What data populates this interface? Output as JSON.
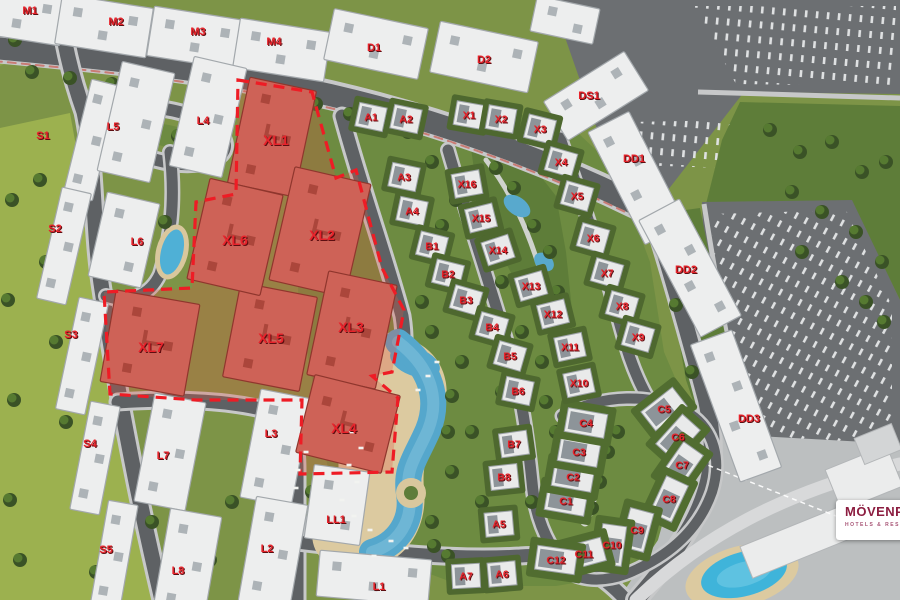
{
  "scene": {
    "width": 900,
    "height": 600,
    "kind": "residential-masterplan-aerial-view"
  },
  "brand": {
    "name": "MÖVENPICK",
    "tagline": "HOTELS & RESORTS",
    "name_color": "#8c1d40",
    "tagline_color": "#a85576"
  },
  "palette": {
    "label_red": "#e8232b",
    "label_shadow": "#5d0e11",
    "block_fill": "#edeeee",
    "block_stroke": "#a3a8ac",
    "block_roof": "#adb3b7",
    "highlight_fill": "#ce6257",
    "highlight_stroke": "#8f362d",
    "highlight_roof": "#ab463b",
    "boundary_red": "#ee1c25",
    "villa_fill": "#e9eaea",
    "villa_stroke": "#9aa0a4",
    "villa_roof": "#8d9499",
    "yard_green": "#4e682f",
    "yard_green_c": "#516d30"
  },
  "highlighted_blocks": [
    {
      "id": "XL1",
      "label": "XL1",
      "x": 272,
      "y": 137,
      "w": 68,
      "h": 108,
      "rot": 12,
      "lx": 276,
      "ly": 140
    },
    {
      "id": "XL2",
      "label": "XL2",
      "x": 320,
      "y": 232,
      "w": 78,
      "h": 116,
      "rot": 13,
      "lx": 322,
      "ly": 235
    },
    {
      "id": "XL3",
      "label": "XL3",
      "x": 352,
      "y": 330,
      "w": 70,
      "h": 106,
      "rot": 12,
      "lx": 351,
      "ly": 327
    },
    {
      "id": "XL4",
      "label": "XL4",
      "x": 348,
      "y": 424,
      "w": 88,
      "h": 80,
      "rot": 14,
      "lx": 344,
      "ly": 428
    },
    {
      "id": "XL5",
      "label": "XL5",
      "x": 270,
      "y": 337,
      "w": 78,
      "h": 96,
      "rot": 11,
      "lx": 271,
      "ly": 338
    },
    {
      "id": "XL6",
      "label": "XL6",
      "x": 235,
      "y": 237,
      "w": 75,
      "h": 103,
      "rot": 13,
      "lx": 235,
      "ly": 240
    },
    {
      "id": "XL7",
      "label": "XL7",
      "x": 150,
      "y": 343,
      "w": 85,
      "h": 93,
      "rot": 10,
      "lx": 151,
      "ly": 347
    }
  ],
  "apartment_blocks": [
    {
      "id": "M1",
      "label": "M1",
      "x": 18,
      "y": 14,
      "w": 92,
      "h": 50,
      "rot": 9,
      "lx": 30,
      "ly": 10
    },
    {
      "id": "M2",
      "label": "M2",
      "x": 104,
      "y": 26,
      "w": 92,
      "h": 50,
      "rot": 9,
      "lx": 116,
      "ly": 21
    },
    {
      "id": "M3",
      "label": "M3",
      "x": 196,
      "y": 38,
      "w": 92,
      "h": 50,
      "rot": 9,
      "lx": 198,
      "ly": 31
    },
    {
      "id": "M4",
      "label": "M4",
      "x": 282,
      "y": 50,
      "w": 92,
      "h": 50,
      "rot": 9,
      "lx": 274,
      "ly": 41
    },
    {
      "id": "D1",
      "label": "D1",
      "x": 376,
      "y": 44,
      "w": 96,
      "h": 52,
      "rot": 12,
      "lx": 374,
      "ly": 47
    },
    {
      "id": "D2",
      "label": "D2",
      "x": 484,
      "y": 57,
      "w": 100,
      "h": 52,
      "rot": 12,
      "lx": 484,
      "ly": 59
    },
    {
      "id": "D3",
      "label": "",
      "x": 565,
      "y": 20,
      "w": 64,
      "h": 36,
      "rot": 12,
      "lx": 0,
      "ly": 0
    },
    {
      "id": "DS1",
      "label": "DS1",
      "x": 596,
      "y": 96,
      "w": 95,
      "h": 46,
      "rot": -32,
      "lx": 589,
      "ly": 95
    },
    {
      "id": "DD1",
      "label": "DD1",
      "x": 637,
      "y": 178,
      "w": 46,
      "h": 126,
      "rot": -27,
      "lx": 634,
      "ly": 158
    },
    {
      "id": "DD2",
      "label": "DD2",
      "x": 690,
      "y": 268,
      "w": 46,
      "h": 132,
      "rot": -28,
      "lx": 686,
      "ly": 269
    },
    {
      "id": "DD3",
      "label": "DD3",
      "x": 736,
      "y": 406,
      "w": 44,
      "h": 146,
      "rot": -20,
      "lx": 749,
      "ly": 418
    },
    {
      "id": "S1",
      "label": "S1",
      "x": 92,
      "y": 140,
      "w": 30,
      "h": 118,
      "rot": 14,
      "lx": 43,
      "ly": 135
    },
    {
      "id": "S2",
      "label": "S2",
      "x": 64,
      "y": 246,
      "w": 30,
      "h": 114,
      "rot": 13,
      "lx": 55,
      "ly": 228
    },
    {
      "id": "S3",
      "label": "S3",
      "x": 82,
      "y": 356,
      "w": 30,
      "h": 114,
      "rot": 12,
      "lx": 71,
      "ly": 334
    },
    {
      "id": "S4",
      "label": "S4",
      "x": 95,
      "y": 458,
      "w": 30,
      "h": 110,
      "rot": 11,
      "lx": 90,
      "ly": 443
    },
    {
      "id": "S5",
      "label": "S5",
      "x": 114,
      "y": 556,
      "w": 30,
      "h": 108,
      "rot": 10,
      "lx": 106,
      "ly": 549
    },
    {
      "id": "L5",
      "label": "L5",
      "x": 136,
      "y": 122,
      "w": 54,
      "h": 112,
      "rot": 13,
      "lx": 113,
      "ly": 126
    },
    {
      "id": "L4",
      "label": "L4",
      "x": 208,
      "y": 117,
      "w": 54,
      "h": 112,
      "rot": 13,
      "lx": 203,
      "ly": 120
    },
    {
      "id": "L6",
      "label": "L6",
      "x": 124,
      "y": 240,
      "w": 54,
      "h": 86,
      "rot": 13,
      "lx": 137,
      "ly": 241
    },
    {
      "id": "L7",
      "label": "L7",
      "x": 170,
      "y": 452,
      "w": 52,
      "h": 110,
      "rot": 11,
      "lx": 163,
      "ly": 455
    },
    {
      "id": "L3",
      "label": "L3",
      "x": 276,
      "y": 448,
      "w": 52,
      "h": 110,
      "rot": 11,
      "lx": 271,
      "ly": 433
    },
    {
      "id": "L8",
      "label": "L8",
      "x": 187,
      "y": 565,
      "w": 52,
      "h": 106,
      "rot": 10,
      "lx": 178,
      "ly": 570
    },
    {
      "id": "L2",
      "label": "L2",
      "x": 273,
      "y": 553,
      "w": 52,
      "h": 106,
      "rot": 10,
      "lx": 267,
      "ly": 548
    },
    {
      "id": "L1",
      "label": "L1",
      "x": 374,
      "y": 578,
      "w": 112,
      "h": 46,
      "rot": 5,
      "lx": 379,
      "ly": 586
    },
    {
      "id": "LL1",
      "label": "LL1",
      "x": 337,
      "y": 505,
      "w": 56,
      "h": 74,
      "rot": 8,
      "lx": 336,
      "ly": 519
    }
  ],
  "villas": [
    {
      "id": "A1",
      "label": "A1",
      "x": 371,
      "y": 117,
      "rot": 12,
      "size": "std"
    },
    {
      "id": "A2",
      "label": "A2",
      "x": 406,
      "y": 119,
      "rot": 12,
      "size": "std"
    },
    {
      "id": "A3",
      "label": "A3",
      "x": 404,
      "y": 177,
      "rot": 12,
      "size": "std"
    },
    {
      "id": "A4",
      "label": "A4",
      "x": 412,
      "y": 211,
      "rot": 12,
      "size": "std"
    },
    {
      "id": "A5",
      "label": "A5",
      "x": 499,
      "y": 524,
      "rot": -5,
      "size": "std"
    },
    {
      "id": "A6",
      "label": "A6",
      "x": 502,
      "y": 574,
      "rot": -5,
      "size": "std"
    },
    {
      "id": "A7",
      "label": "A7",
      "x": 466,
      "y": 576,
      "rot": -3,
      "size": "std"
    },
    {
      "id": "B1",
      "label": "B1",
      "x": 432,
      "y": 246,
      "rot": 14,
      "size": "std"
    },
    {
      "id": "B2",
      "label": "B2",
      "x": 448,
      "y": 274,
      "rot": 14,
      "size": "std"
    },
    {
      "id": "B3",
      "label": "B3",
      "x": 466,
      "y": 300,
      "rot": 16,
      "size": "std"
    },
    {
      "id": "B4",
      "label": "B4",
      "x": 492,
      "y": 327,
      "rot": 16,
      "size": "std"
    },
    {
      "id": "B5",
      "label": "B5",
      "x": 510,
      "y": 356,
      "rot": 16,
      "size": "std"
    },
    {
      "id": "B6",
      "label": "B6",
      "x": 518,
      "y": 391,
      "rot": 12,
      "size": "std"
    },
    {
      "id": "B7",
      "label": "B7",
      "x": 514,
      "y": 444,
      "rot": -8,
      "size": "std"
    },
    {
      "id": "B8",
      "label": "B8",
      "x": 504,
      "y": 477,
      "rot": -6,
      "size": "std"
    },
    {
      "id": "C1",
      "label": "C1",
      "x": 566,
      "y": 501,
      "rot": 10,
      "size": "wide"
    },
    {
      "id": "C2",
      "label": "C2",
      "x": 573,
      "y": 477,
      "rot": 10,
      "size": "wide"
    },
    {
      "id": "C3",
      "label": "C3",
      "x": 579,
      "y": 452,
      "rot": 10,
      "size": "wide"
    },
    {
      "id": "C4",
      "label": "C4",
      "x": 586,
      "y": 423,
      "rot": 10,
      "size": "wide"
    },
    {
      "id": "C5",
      "label": "C5",
      "x": 664,
      "y": 409,
      "rot": -38,
      "size": "wide"
    },
    {
      "id": "C6",
      "label": "C6",
      "x": 678,
      "y": 437,
      "rot": -48,
      "size": "wide"
    },
    {
      "id": "C7",
      "label": "C7",
      "x": 682,
      "y": 465,
      "rot": -55,
      "size": "wide"
    },
    {
      "id": "C8",
      "label": "C8",
      "x": 669,
      "y": 499,
      "rot": -65,
      "size": "wide"
    },
    {
      "id": "C9",
      "label": "C9",
      "x": 637,
      "y": 530,
      "rot": -75,
      "size": "wide"
    },
    {
      "id": "C10",
      "label": "C10",
      "x": 612,
      "y": 545,
      "rot": -82,
      "size": "wide"
    },
    {
      "id": "C11",
      "label": "C11",
      "x": 584,
      "y": 554,
      "rot": -15,
      "size": "wide"
    },
    {
      "id": "C12",
      "label": "C12",
      "x": 556,
      "y": 560,
      "rot": 8,
      "size": "wide"
    },
    {
      "id": "X1",
      "label": "X1",
      "x": 469,
      "y": 115,
      "rot": 10,
      "size": "std"
    },
    {
      "id": "X2",
      "label": "X2",
      "x": 501,
      "y": 119,
      "rot": 10,
      "size": "std"
    },
    {
      "id": "X3",
      "label": "X3",
      "x": 540,
      "y": 129,
      "rot": 14,
      "size": "std"
    },
    {
      "id": "X4",
      "label": "X4",
      "x": 561,
      "y": 162,
      "rot": 16,
      "size": "std"
    },
    {
      "id": "X5",
      "label": "X5",
      "x": 577,
      "y": 196,
      "rot": 16,
      "size": "std"
    },
    {
      "id": "X6",
      "label": "X6",
      "x": 593,
      "y": 238,
      "rot": 16,
      "size": "std"
    },
    {
      "id": "X7",
      "label": "X7",
      "x": 607,
      "y": 273,
      "rot": 16,
      "size": "std"
    },
    {
      "id": "X8",
      "label": "X8",
      "x": 622,
      "y": 306,
      "rot": 16,
      "size": "std"
    },
    {
      "id": "X9",
      "label": "X9",
      "x": 638,
      "y": 337,
      "rot": 16,
      "size": "std"
    },
    {
      "id": "X10",
      "label": "X10",
      "x": 579,
      "y": 383,
      "rot": -12,
      "size": "std"
    },
    {
      "id": "X11",
      "label": "X11",
      "x": 570,
      "y": 347,
      "rot": -12,
      "size": "std"
    },
    {
      "id": "X12",
      "label": "X12",
      "x": 553,
      "y": 314,
      "rot": -14,
      "size": "std"
    },
    {
      "id": "X13",
      "label": "X13",
      "x": 531,
      "y": 286,
      "rot": -16,
      "size": "std"
    },
    {
      "id": "X14",
      "label": "X14",
      "x": 498,
      "y": 250,
      "rot": -18,
      "size": "std"
    },
    {
      "id": "X15",
      "label": "X15",
      "x": 481,
      "y": 218,
      "rot": -14,
      "size": "std"
    },
    {
      "id": "X16",
      "label": "X16",
      "x": 467,
      "y": 184,
      "rot": -10,
      "size": "std"
    }
  ]
}
